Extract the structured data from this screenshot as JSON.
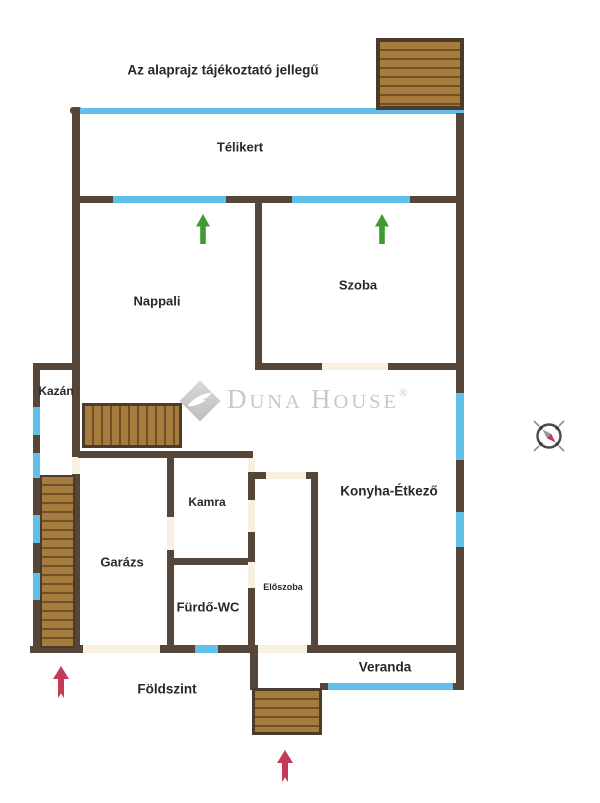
{
  "disclaimer": "Az alaprajz tájékoztató jellegű",
  "floor_label": "Földszint",
  "rooms": {
    "telikert": "Télikert",
    "nappali": "Nappali",
    "szoba": "Szoba",
    "kazan": "Kazán",
    "kamra": "Kamra",
    "garazs": "Garázs",
    "furdo_wc": "Fürdő-WC",
    "eloszoba": "Előszoba",
    "konyha_etkezo": "Konyha-Étkező",
    "veranda": "Veranda"
  },
  "watermark": {
    "d1": "D",
    "s1": "UNA",
    "d2": "H",
    "s2": "OUSE",
    "registered": "®"
  },
  "icons": {
    "green_arrows": [
      "green-up-arrow in Nappali",
      "green-up-arrow in Szoba"
    ],
    "red_arrows": [
      "red-up-arrow at left entrance",
      "red-up-arrow at bottom entrance"
    ],
    "compass": "compass needle pointing NW-SE"
  },
  "colors": {
    "wall": "#564639",
    "window": "#5fc1ea",
    "door_gap": "#f8f0e1",
    "stairs_fill": "#a57c3e",
    "stairs_line": "#6e5226",
    "stairs_border": "#4c3b2b",
    "green_arrow": "#3f9b2f",
    "red_arrow": "#c43b57",
    "watermark_gray": "#c8c8c8",
    "text": "#282828"
  }
}
